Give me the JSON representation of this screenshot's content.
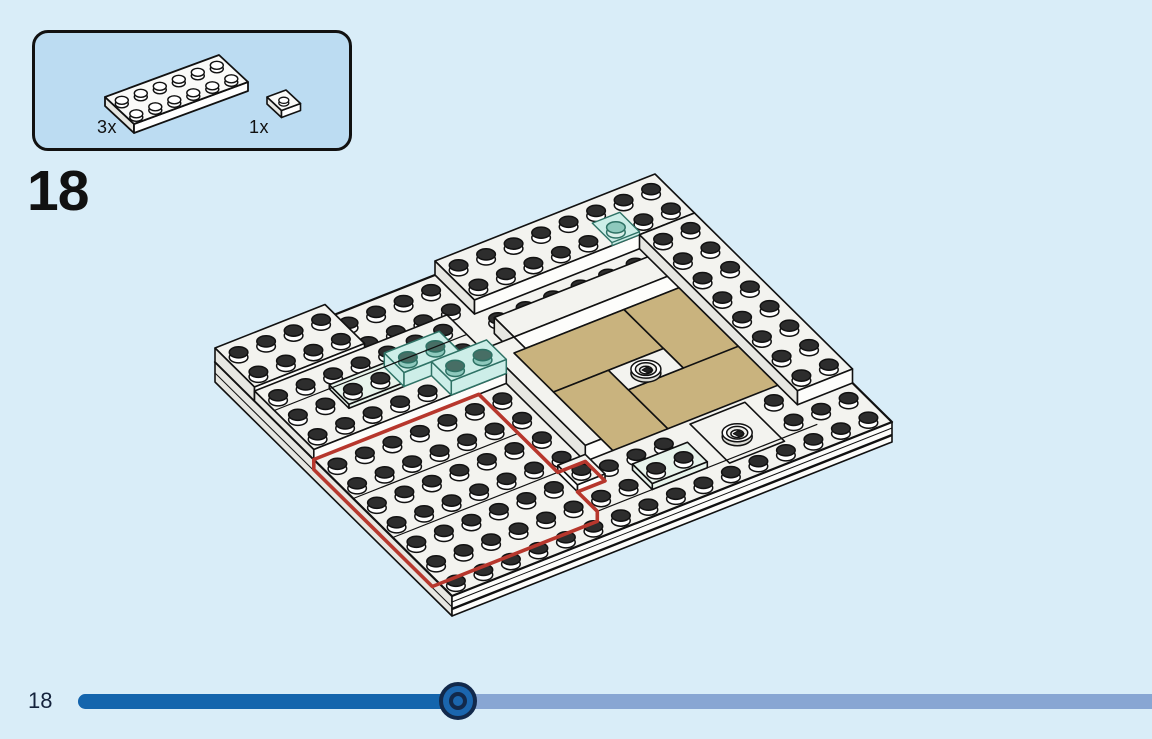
{
  "parts_callout": {
    "parts": [
      {
        "name": "plate-2x6-white",
        "qty": "3x"
      },
      {
        "name": "plate-1x1-white",
        "qty": "1x"
      }
    ]
  },
  "step": {
    "number": "18"
  },
  "footer": {
    "page_label": "18",
    "progress_percent": 35.4
  },
  "illustration": {
    "colors": {
      "background": "#d9edf8",
      "callout_fill": "#bcdcf2",
      "outline": "#111111",
      "brick_top": "#f3f3ef",
      "brick_side_light": "#fdfdfb",
      "brick_side_shade": "#e7e7e2",
      "stud_top": "#2d2d2d",
      "tan": "#c9b37e",
      "trans_blue_fill": "#cdeee8",
      "trans_blue_stroke": "#2e7265",
      "trans_blue_stud": "#8ec9bd",
      "mint_fill": "#e8f4ec",
      "highlight_red": "#b7372d",
      "slider_fill": "#1465ad",
      "slider_track": "#88a6d3",
      "slider_handle_dark": "#12294b",
      "slider_handle_blue": "#1b66ae",
      "text": "#15233c"
    }
  }
}
